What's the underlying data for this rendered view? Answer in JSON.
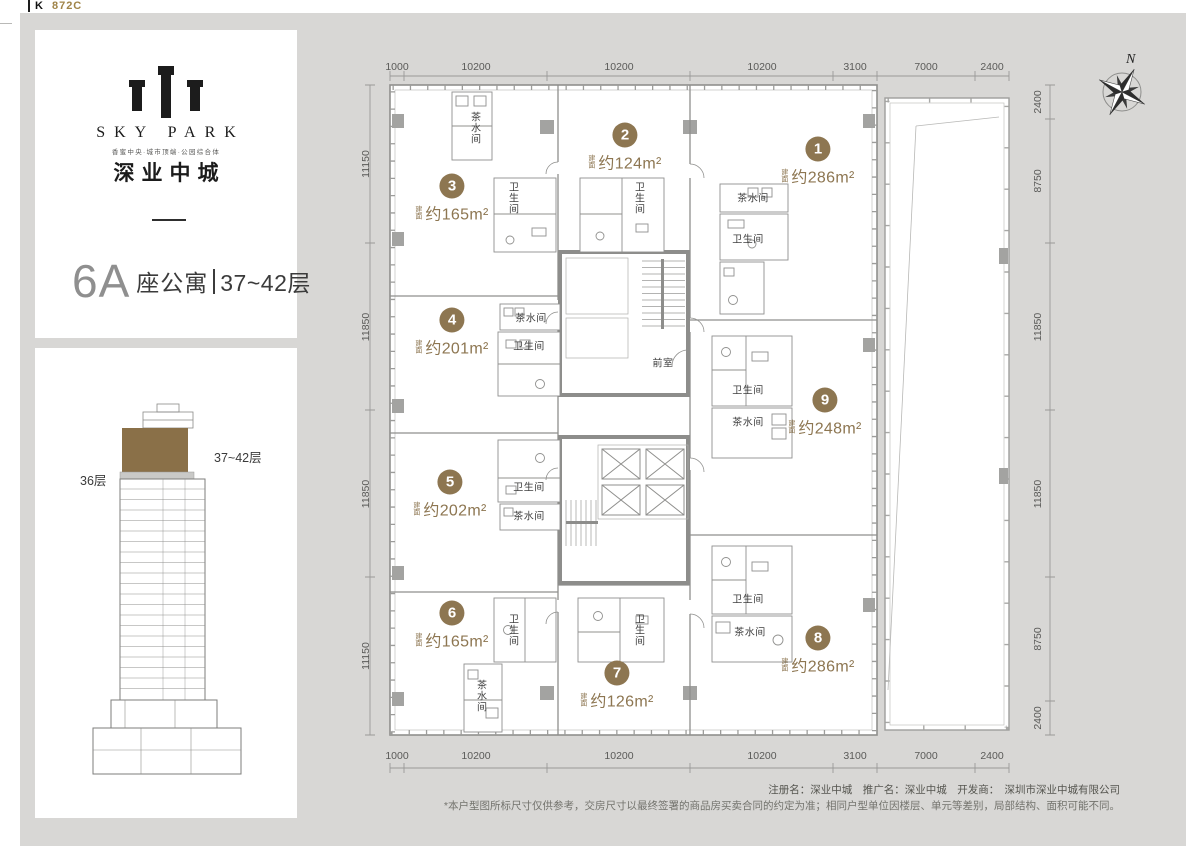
{
  "page": {
    "code_prefix": "K",
    "code": "872C"
  },
  "colors": {
    "accent_gold": "#8d7651",
    "background_gray": "#d8d7d5",
    "highlight_brown": "#8a7048"
  },
  "sidebar": {
    "logo_name": "SKY PARK",
    "logo_tagline": "香蜜中央·城市顶端·公园综合体",
    "logo_cn": "深业中城",
    "title_block": "6A",
    "title_type": "座公寓",
    "title_floors": "37~42层",
    "elevation": {
      "highlight_label": "37~42层",
      "floor36_label": "36层"
    }
  },
  "plan": {
    "compass": "N",
    "units": [
      {
        "no": "1",
        "prefix": "建面",
        "area": "约286m²",
        "x": 818,
        "y": 162
      },
      {
        "no": "2",
        "prefix": "建面",
        "area": "约124m²",
        "x": 625,
        "y": 148
      },
      {
        "no": "3",
        "prefix": "建面",
        "area": "约165m²",
        "x": 452,
        "y": 199
      },
      {
        "no": "4",
        "prefix": "建面",
        "area": "约201m²",
        "x": 452,
        "y": 333
      },
      {
        "no": "5",
        "prefix": "建面",
        "area": "约202m²",
        "x": 450,
        "y": 495
      },
      {
        "no": "6",
        "prefix": "建面",
        "area": "约165m²",
        "x": 452,
        "y": 626
      },
      {
        "no": "7",
        "prefix": "建面",
        "area": "约126m²",
        "x": 617,
        "y": 686
      },
      {
        "no": "8",
        "prefix": "建面",
        "area": "约286m²",
        "x": 818,
        "y": 651
      },
      {
        "no": "9",
        "prefix": "建面",
        "area": "约248m²",
        "x": 825,
        "y": 413
      }
    ],
    "rooms": [
      {
        "t": "茶水间",
        "x": 474,
        "y": 128,
        "vert": true
      },
      {
        "t": "卫生间",
        "x": 512,
        "y": 198,
        "vert": true
      },
      {
        "t": "卫生间",
        "x": 638,
        "y": 198,
        "vert": true
      },
      {
        "t": "茶水间",
        "x": 753,
        "y": 197
      },
      {
        "t": "卫生间",
        "x": 748,
        "y": 238
      },
      {
        "t": "茶水间",
        "x": 531,
        "y": 317
      },
      {
        "t": "卫生间",
        "x": 529,
        "y": 345
      },
      {
        "t": "前室",
        "x": 663,
        "y": 362
      },
      {
        "t": "卫生间",
        "x": 529,
        "y": 486
      },
      {
        "t": "茶水间",
        "x": 529,
        "y": 515
      },
      {
        "t": "卫生间",
        "x": 748,
        "y": 389
      },
      {
        "t": "茶水间",
        "x": 748,
        "y": 421
      },
      {
        "t": "卫生间",
        "x": 748,
        "y": 598
      },
      {
        "t": "茶水间",
        "x": 750,
        "y": 631
      },
      {
        "t": "卫生间",
        "x": 512,
        "y": 630,
        "vert": true
      },
      {
        "t": "卫生间",
        "x": 638,
        "y": 630,
        "vert": true
      },
      {
        "t": "茶水间",
        "x": 480,
        "y": 696,
        "vert": true
      }
    ],
    "dims_top": [
      {
        "v": "1000",
        "x": 397
      },
      {
        "v": "10200",
        "x": 476
      },
      {
        "v": "10200",
        "x": 619
      },
      {
        "v": "10200",
        "x": 762
      },
      {
        "v": "3100",
        "x": 855
      },
      {
        "v": "7000",
        "x": 926
      },
      {
        "v": "2400",
        "x": 992
      }
    ],
    "dims_bottom": [
      {
        "v": "1000",
        "x": 397
      },
      {
        "v": "10200",
        "x": 476
      },
      {
        "v": "10200",
        "x": 619
      },
      {
        "v": "10200",
        "x": 762
      },
      {
        "v": "3100",
        "x": 855
      },
      {
        "v": "7000",
        "x": 926
      },
      {
        "v": "2400",
        "x": 992
      }
    ],
    "dims_left": [
      {
        "v": "11150",
        "y": 164
      },
      {
        "v": "11850",
        "y": 327
      },
      {
        "v": "11850",
        "y": 494
      },
      {
        "v": "11150",
        "y": 656
      }
    ],
    "dims_right": [
      {
        "v": "2400",
        "y": 102
      },
      {
        "v": "8750",
        "y": 181
      },
      {
        "v": "11850",
        "y": 327
      },
      {
        "v": "11850",
        "y": 494
      },
      {
        "v": "8750",
        "y": 639
      },
      {
        "v": "2400",
        "y": 718
      }
    ]
  },
  "footer": {
    "line1": "注册名：深业中城　推广名：深业中城　开发商：　深圳市深业中城有限公司",
    "line2": "*本户型图所标尺寸仅供参考，交房尺寸以最终签署的商品房买卖合同的约定为准；相同户型单位因楼层、单元等差别，局部结构、面积可能不同。"
  }
}
